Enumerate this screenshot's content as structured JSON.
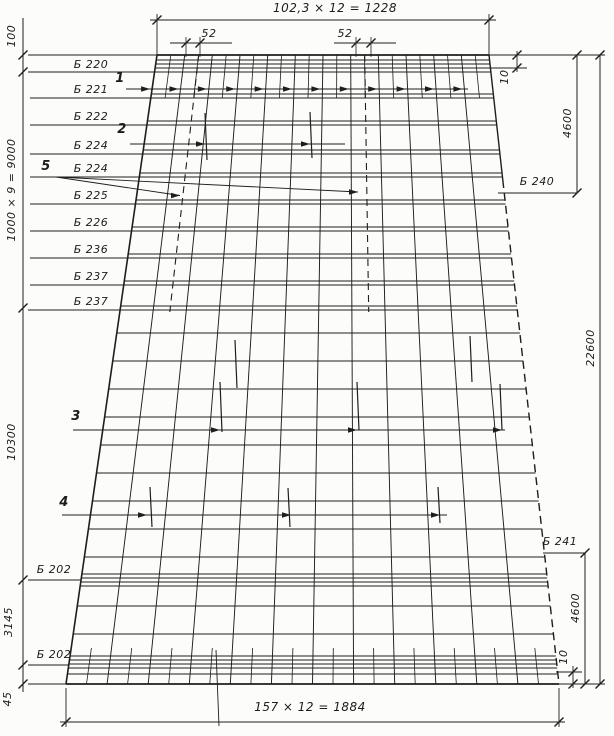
{
  "drawing": {
    "top_dimension": "102,3 × 12 = 1228",
    "bottom_dimension": "157 × 12 = 1884",
    "spacing_52_left": "52",
    "spacing_52_right": "52",
    "left_dimensions": {
      "d100": "100",
      "d9000": "1000 × 9 = 9000",
      "d10300": "10300",
      "d3145": "3145",
      "d45": "45"
    },
    "right_dimensions": {
      "d10_top": "10",
      "d4600_top": "4600",
      "d22600": "22600",
      "d4600_bottom": "4600",
      "d10_bottom": "10"
    },
    "beam_labels_left": [
      "Б 220",
      "Б 221",
      "Б 222",
      "Б 224",
      "Б 224",
      "Б 225",
      "Б 226",
      "Б 236",
      "Б 237",
      "Б 237"
    ],
    "beam_labels_bottom_left": [
      "Б 202",
      "Б 202"
    ],
    "beam_labels_right": [
      "Б 240",
      "Б 241"
    ],
    "callout_numbers": [
      "1",
      "2",
      "3",
      "4",
      "5"
    ]
  }
}
